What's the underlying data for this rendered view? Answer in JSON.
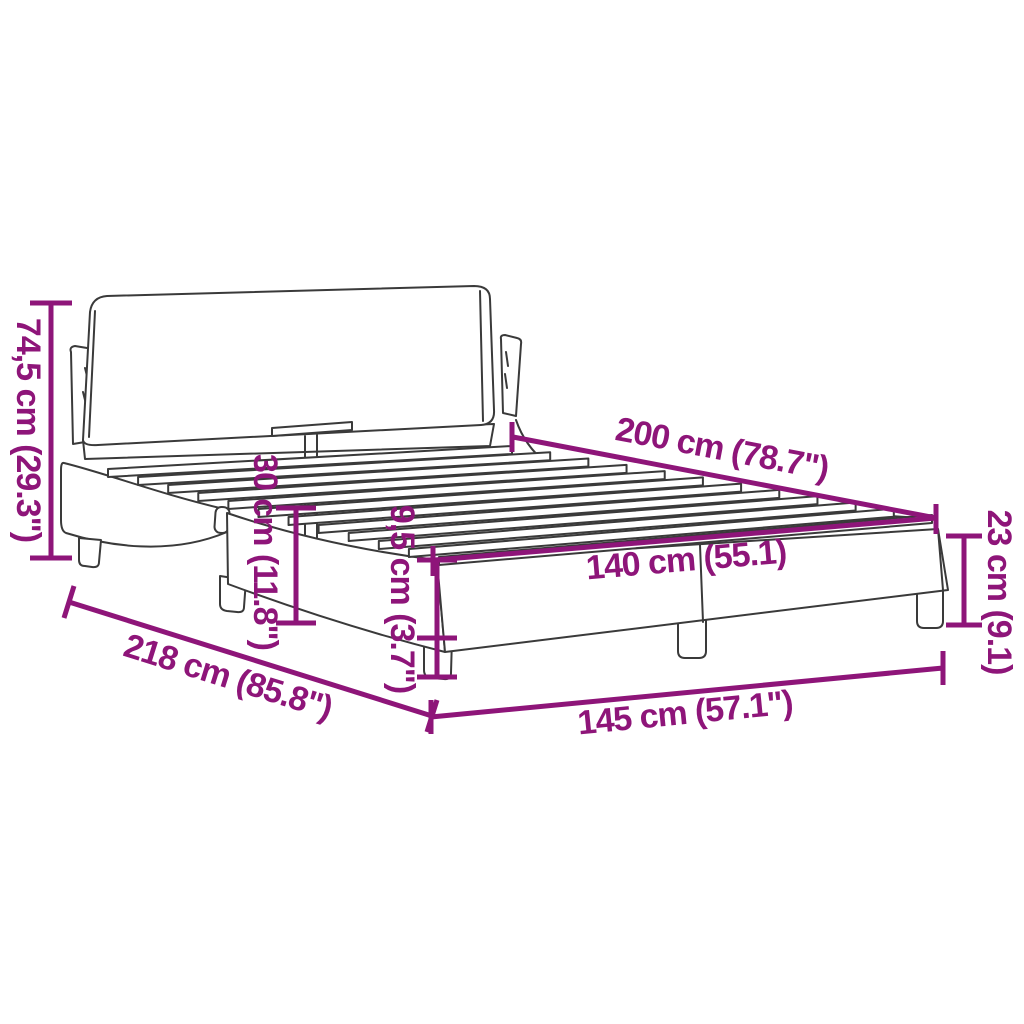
{
  "page": {
    "background": "#ffffff"
  },
  "diagram": {
    "title": "Bed frame with headboard dimension diagram",
    "accent_color": "#8e1579",
    "line_color": "#3a3a3a"
  },
  "labels": {
    "total_height": "74,5 cm (29.3\")",
    "length": "200 cm (78.7\")",
    "base_length": "218 cm (85.8\")",
    "side_rail_height": "30 cm (11.8\")",
    "clearance_height": "9,5 cm (3.7\")",
    "inner_width": "140 cm (55.1)",
    "foot_end_height": "23 cm (9.1)",
    "total_width": "145 cm (57.1\")"
  },
  "slat_deck": {
    "count": 12,
    "back_left": [
      108,
      469
    ],
    "back_right": [
      512,
      446
    ],
    "front_left": [
      439,
      557
    ],
    "front_right": [
      932,
      515
    ],
    "thickness": 8
  }
}
